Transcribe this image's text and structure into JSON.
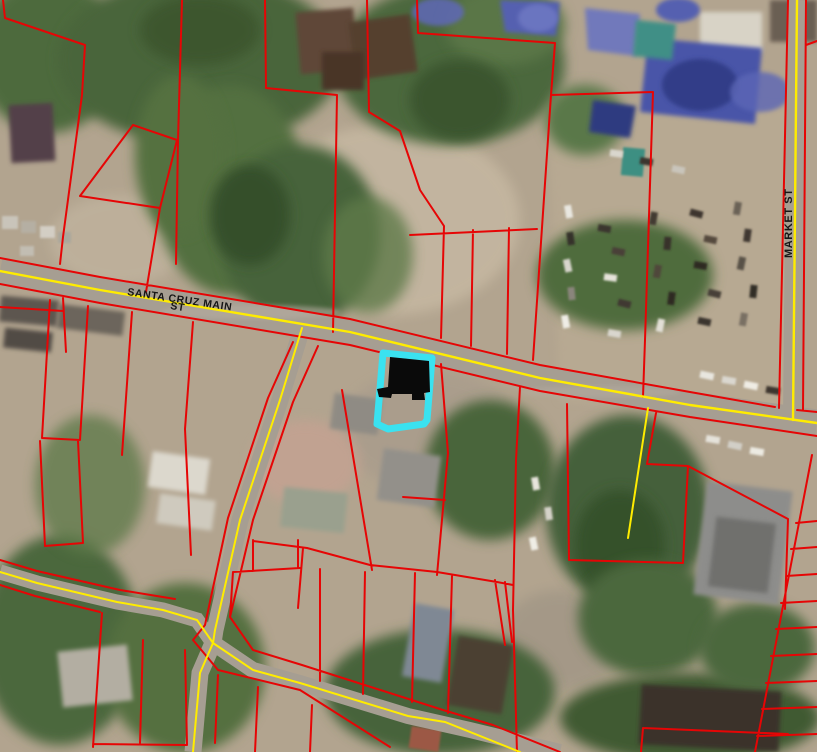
{
  "map": {
    "street_labels": {
      "santa_cruz_line1": "SANTA CRUZ MAIN",
      "santa_cruz_line2": "ST",
      "market": "MARKET ST"
    },
    "colors": {
      "parcel_boundary": "#e60505",
      "road_centerline": "#ffec00",
      "selected_parcel": "#3ae2f0",
      "building_footprint": "#0a0a0a",
      "street_label": "#161616"
    }
  }
}
